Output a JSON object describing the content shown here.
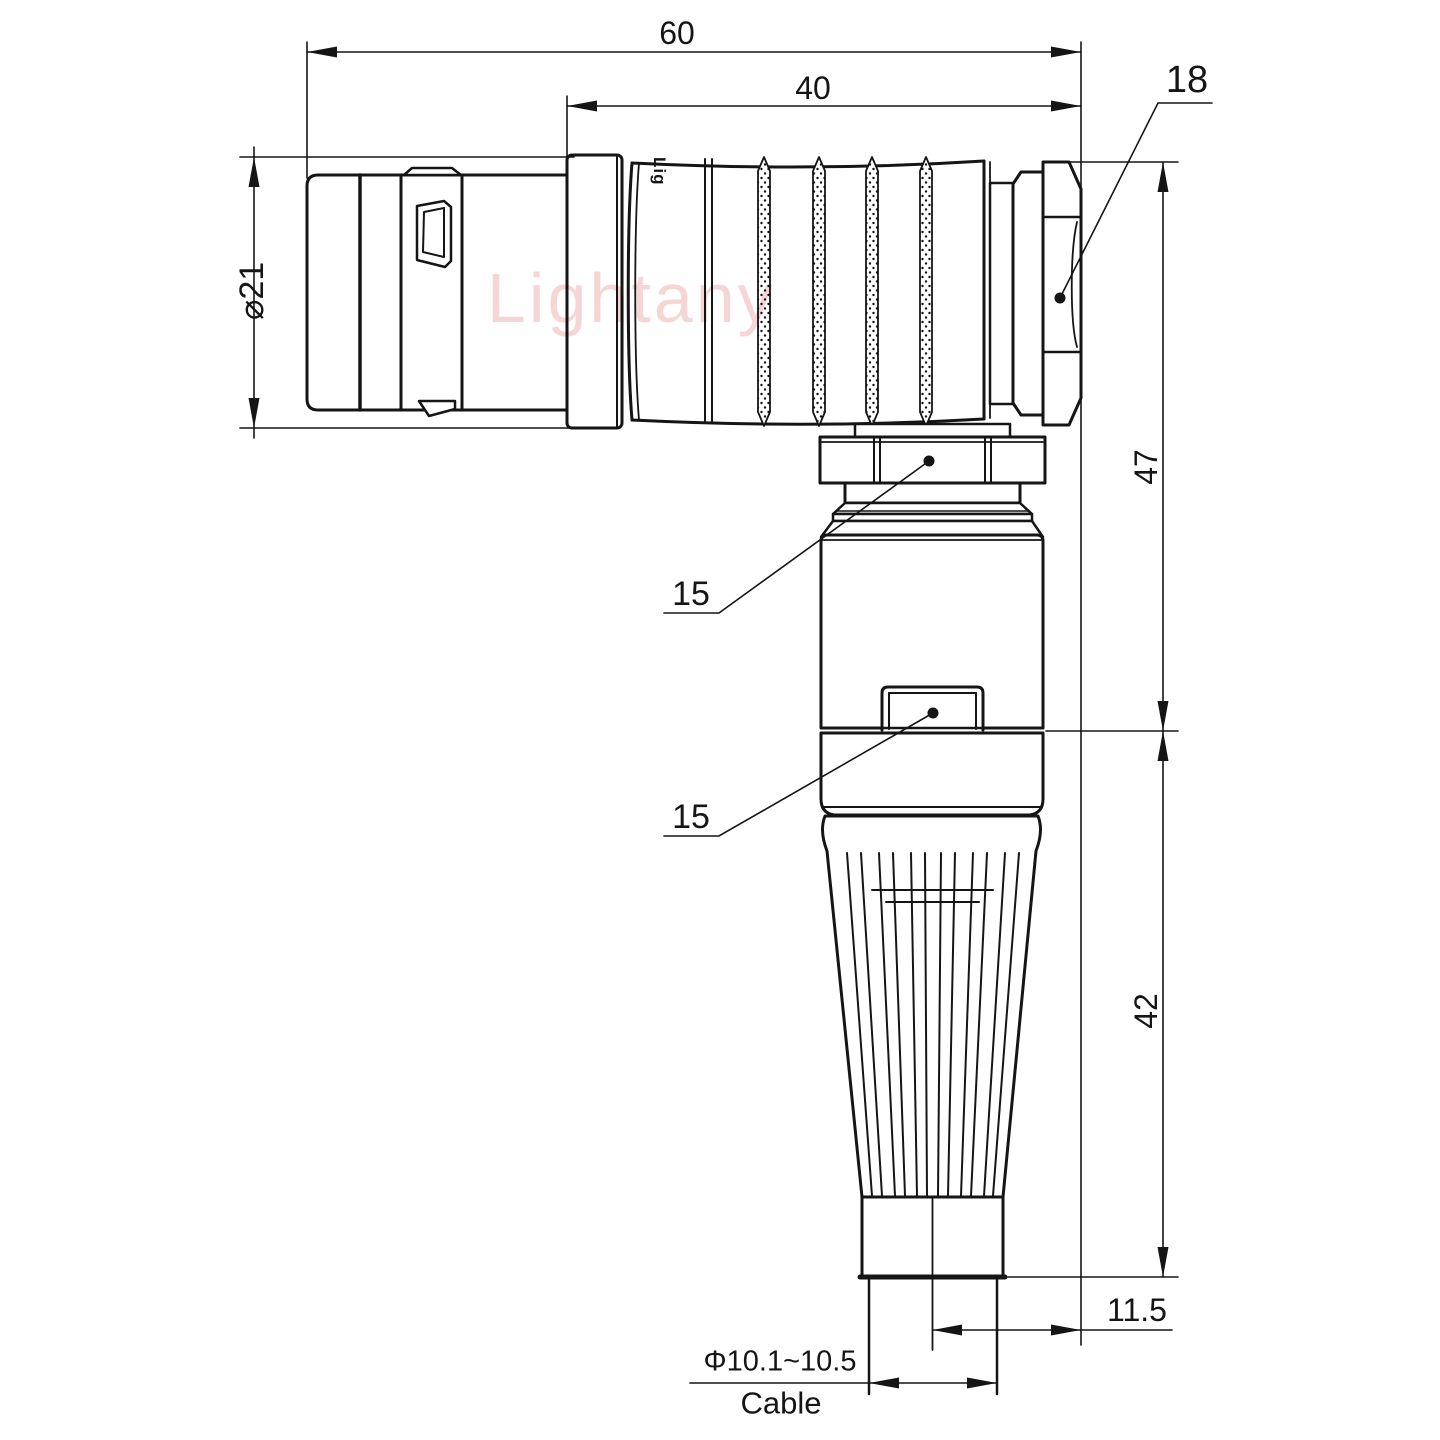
{
  "watermark": {
    "text": "Lightany",
    "color": "#efb2b2"
  },
  "part_marking": {
    "text": "Lig"
  },
  "dims": {
    "overall_length": "60",
    "rear_section_length": "40",
    "coupling_nut_hex": "18",
    "front_shell_diameter": "⌀21",
    "elbow_nut_flats": "15",
    "elbow_body_flats": "15",
    "upper_height": "47",
    "lower_height": "42",
    "cable_exit_offset": "11.5",
    "cable_diameter_range": "Φ10.1~10.5",
    "cable_label": "Cable"
  },
  "style": {
    "line_color": "#151515",
    "background": "#ffffff"
  }
}
